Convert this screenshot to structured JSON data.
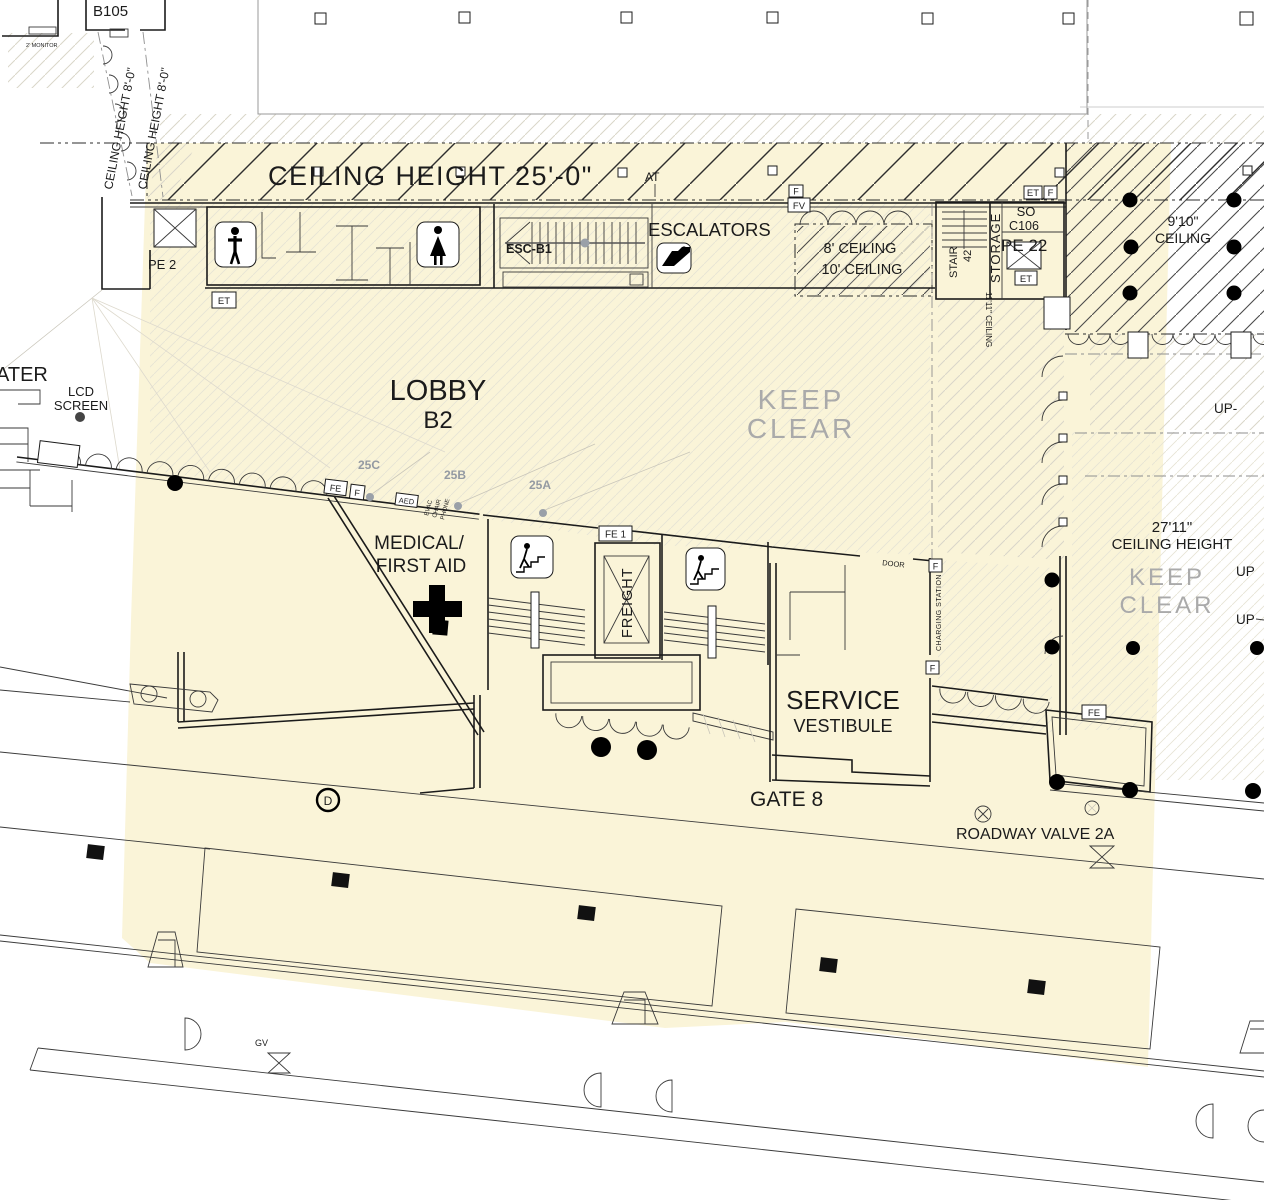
{
  "title": "Architectural floor plan — Lobby B2 gate level",
  "colors": {
    "highlight": "#faf4d8",
    "hatch_light": "#d9d6c9",
    "hatch_bold": "#2e2e2e",
    "line": "#1b1b1b",
    "gray_text": "#aaaaaa"
  },
  "rooms": {
    "b105": "B105",
    "lobby_line1": "LOBBY",
    "lobby_line2": "B2",
    "medical_line1": "MEDICAL/",
    "medical_line2": "FIRST AID",
    "service_line1": "SERVICE",
    "service_line2": "VESTIBULE",
    "storage": "STORAGE",
    "stair_line1": "STAIR",
    "stair_line2": "42",
    "so": "SO",
    "so_num": "C106",
    "pe2": "PE 2",
    "pe22": "PE 22",
    "freight": "FREIGHT",
    "escalators": "ESCALATORS",
    "esc_b1": "ESC-B1"
  },
  "ceilings": {
    "banner": "CEILING HEIGHT 25'-0\"",
    "h8_left": "CEILING HEIGHT 8'-0\"",
    "h8_right": "CEILING HEIGHT 8'-0\"",
    "c8": "8' CEILING",
    "c10": "10' CEILING",
    "c910_line1": "9'10\"",
    "c910_line2": "CEILING",
    "c1111": "11'11\" CEILING",
    "c2711_line1": "27'11\"",
    "c2711_line2": "CEILING HEIGHT"
  },
  "zones": {
    "keep_line1": "KEEP",
    "keep_line2": "CLEAR",
    "gate8": "GATE 8",
    "roadway_valve": "ROADWAY VALVE 2A",
    "up_dash": "UP-",
    "up": "UP"
  },
  "equipment": {
    "lcd_line1": "LCD",
    "lcd_line2": "SCREEN",
    "ater": "ATER",
    "monitor": "2' MONITOR",
    "charging": "CHARGING STATION",
    "door": "DOOR",
    "aed": "AED",
    "evac_line1": "EVAC",
    "evac_line2": "CHAIR",
    "evac_line3": "PHONE",
    "gv": "GV",
    "d_grid": "D"
  },
  "tags": {
    "at": "AT",
    "et": "ET",
    "f": "F",
    "fv": "FV",
    "fe": "FE",
    "fe1": "FE 1",
    "g25a": "25A",
    "g25b": "25B",
    "g25c": "25C"
  }
}
